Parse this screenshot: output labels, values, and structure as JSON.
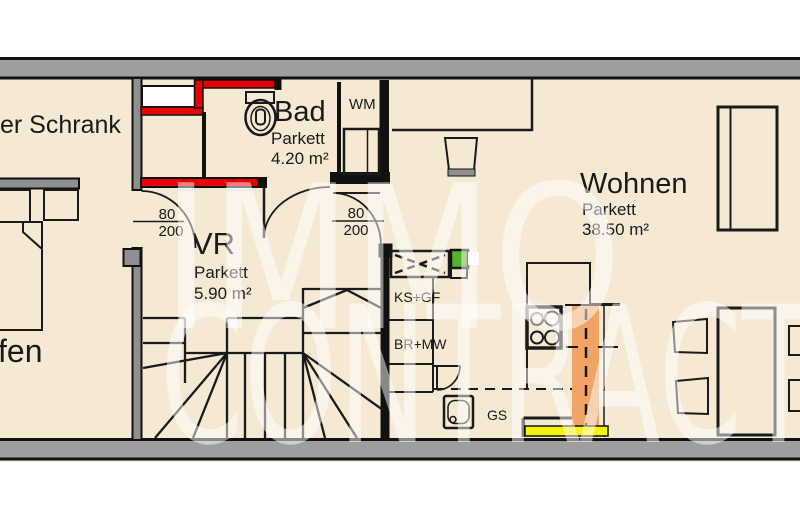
{
  "watermark": {
    "line1": "IMMO",
    "line2": "CONTRACT"
  },
  "rooms": {
    "schrank": {
      "label": "er Schrank"
    },
    "schlafen": {
      "label": "fen"
    },
    "vr": {
      "name": "VR",
      "floor": "Parkett",
      "area": "5.90 m²"
    },
    "bad": {
      "name": "Bad",
      "floor": "Parkett",
      "area": "4.20 m²"
    },
    "wohnen": {
      "name": "Wohnen",
      "floor": "Parkett",
      "area": "38.50 m²"
    }
  },
  "fixtures": {
    "washing_machine": "WM",
    "fridge_freezer": "KS+GF",
    "oven_microwave": "BR+MW",
    "dishwasher": "GS"
  },
  "doors": {
    "left": {
      "width": "80",
      "height": "200"
    },
    "right": {
      "width": "80",
      "height": "200"
    }
  },
  "colors": {
    "floor_beige": "#f5e9d4",
    "wall_gray": "#9e9e9e",
    "interior_wall_gray": "#8f8f8f",
    "highlight_red": "#e60000",
    "counter_orange": "#f2a467",
    "accent_yellow": "#f4f40a",
    "accent_green": "#54b32a",
    "shaft_white": "#ffffff"
  }
}
